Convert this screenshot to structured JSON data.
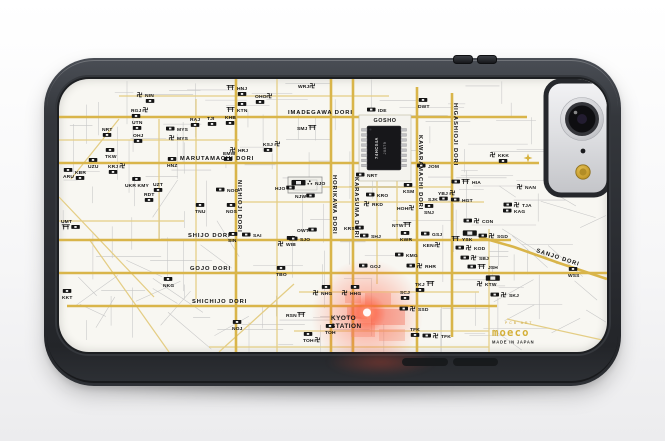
{
  "branding": {
    "logo_small": "PCB ART",
    "logo": "moeco",
    "made_in": "MADE IN JAPAN"
  },
  "map": {
    "chip": {
      "area_label": "GOSHO",
      "line1": "74HC04A",
      "line2": "J0879"
    },
    "station": {
      "line1": "KYOTO",
      "line2": "STATION"
    },
    "streets": {
      "horizontal": [
        {
          "name": "IMADEGAWA DORI",
          "y": 38,
          "x1": 0,
          "x2": 468,
          "lx": 229,
          "ly": 35
        },
        {
          "name": "MARUTAMACHI DORI",
          "y": 84,
          "x1": 0,
          "x2": 480,
          "lx": 121,
          "ly": 81
        },
        {
          "name": "SHIJO DORI",
          "y": 161,
          "x1": 0,
          "x2": 452,
          "lx": 129,
          "ly": 158
        },
        {
          "name": "GOJO DORI",
          "y": 194,
          "x1": 0,
          "x2": 548,
          "lx": 131,
          "ly": 191
        },
        {
          "name": "SHICHIJO DORI",
          "y": 227,
          "x1": 8,
          "x2": 438,
          "lx": 133,
          "ly": 224
        }
      ],
      "vertical": [
        {
          "name": "NISHIOJI DORI",
          "x": 177,
          "y1": 0,
          "y2": 273,
          "lx": 179,
          "ly": 101
        },
        {
          "name": "HORIKAWA DORI",
          "x": 272,
          "y1": 0,
          "y2": 273,
          "lx": 274,
          "ly": 96
        },
        {
          "name": "KARASUMA DORI",
          "x": 294,
          "y1": 0,
          "y2": 273,
          "lx": 296,
          "ly": 98
        },
        {
          "name": "KAWARAMACHI DORI",
          "x": 358,
          "y1": 8,
          "y2": 273,
          "lx": 360,
          "ly": 56
        },
        {
          "name": "HIGASHIOJI DORI",
          "x": 393,
          "y1": 14,
          "y2": 258,
          "lx": 395,
          "ly": 24
        }
      ],
      "diagonal": {
        "name": "SANJO DORI",
        "pts": "420,158 455,168 500,184 548,200",
        "lx": 477,
        "ly": 173,
        "rot": 18
      }
    },
    "minor_gold": [
      [
        60,
        17,
        330,
        17
      ],
      [
        0,
        61,
        180,
        61
      ],
      [
        230,
        108,
        392,
        108
      ],
      [
        180,
        123,
        425,
        123
      ],
      [
        0,
        142,
        125,
        142
      ],
      [
        240,
        213,
        420,
        213
      ],
      [
        235,
        252,
        430,
        252
      ],
      [
        150,
        268,
        430,
        268
      ],
      [
        137,
        20,
        137,
        220
      ],
      [
        218,
        0,
        218,
        273
      ],
      [
        318,
        84,
        318,
        205
      ],
      [
        338,
        84,
        338,
        161
      ],
      [
        430,
        150,
        430,
        273
      ],
      [
        100,
        40,
        100,
        160
      ],
      [
        30,
        160,
        110,
        273
      ],
      [
        0,
        118,
        95,
        218
      ],
      [
        160,
        273,
        235,
        205
      ],
      [
        12,
        100,
        60,
        40
      ],
      [
        448,
        240,
        548,
        262
      ]
    ],
    "labels": [
      [
        86,
        18,
        "NIN",
        "m",
        "",
        "",
        "r"
      ],
      [
        72,
        33,
        "RGJ",
        "",
        "m",
        "",
        "r"
      ],
      [
        73,
        45,
        "UTN",
        "",
        "",
        "",
        "r"
      ],
      [
        43,
        52,
        "NRT",
        "",
        "",
        "",
        "r"
      ],
      [
        74,
        58,
        "OHJ",
        "",
        "",
        "",
        "r"
      ],
      [
        131,
        42,
        "RAJ",
        "",
        "",
        "",
        "r"
      ],
      [
        148,
        41,
        "TJI",
        "",
        "",
        "",
        "r"
      ],
      [
        166,
        40,
        "KHB",
        "",
        "",
        "",
        "r"
      ],
      [
        118,
        52,
        "MYS",
        "r",
        "",
        "",
        ""
      ],
      [
        118,
        61,
        "MYS",
        "m",
        "",
        "",
        ""
      ],
      [
        178,
        33,
        "KTN",
        "t",
        "",
        "r",
        ""
      ],
      [
        178,
        11,
        "HNJ",
        "t",
        "",
        "",
        "r"
      ],
      [
        196,
        19,
        "OHO",
        "",
        "m",
        "",
        "r"
      ],
      [
        239,
        9,
        "WRJ",
        "",
        "m",
        "",
        ""
      ],
      [
        238,
        51,
        "SMJ",
        "",
        "t",
        "",
        ""
      ],
      [
        204,
        67,
        "KSJ",
        "",
        "m",
        "",
        "r"
      ],
      [
        179,
        73,
        "HRJ",
        "m",
        "",
        "",
        ""
      ],
      [
        164,
        76,
        "EMW",
        "",
        "",
        "",
        "r"
      ],
      [
        46,
        79,
        "TKW",
        "",
        "",
        "r",
        ""
      ],
      [
        29,
        89,
        "UZU",
        "",
        "",
        "r",
        ""
      ],
      [
        16,
        95,
        "KBR",
        "",
        "",
        "",
        "r"
      ],
      [
        4,
        99,
        "ARU",
        "",
        "",
        "r",
        ""
      ],
      [
        49,
        89,
        "KRJ",
        "",
        "m",
        "",
        "r"
      ],
      [
        108,
        88,
        "HNZ",
        "",
        "",
        "r",
        ""
      ],
      [
        66,
        108,
        "UKR KMY",
        "",
        "",
        "r",
        ""
      ],
      [
        94,
        107,
        "UZT",
        "",
        "",
        "",
        "r"
      ],
      [
        85,
        117,
        "RDT",
        "",
        "",
        "",
        "r"
      ],
      [
        168,
        113,
        "NOO",
        "r",
        "",
        "",
        ""
      ],
      [
        136,
        134,
        "TNU",
        "",
        "",
        "r",
        ""
      ],
      [
        167,
        134,
        "NOS",
        "",
        "",
        "r",
        ""
      ],
      [
        216,
        111,
        "HJO",
        "",
        "r",
        "",
        ""
      ],
      [
        236,
        119,
        "NJW",
        "",
        "r",
        "",
        ""
      ],
      [
        256,
        106,
        "NJO",
        "Rc",
        "",
        "",
        ""
      ],
      [
        2,
        144,
        "UMT",
        "",
        "",
        "",
        "tr"
      ],
      [
        169,
        163,
        "SIN",
        "",
        "",
        "r",
        ""
      ],
      [
        194,
        158,
        "SAI",
        "r",
        "",
        "",
        ""
      ],
      [
        227,
        167,
        "WIB",
        "m",
        "",
        "r",
        ""
      ],
      [
        238,
        153,
        "OWT",
        "",
        "r",
        "",
        ""
      ],
      [
        241,
        162,
        "SJO",
        "r",
        "",
        "",
        ""
      ],
      [
        285,
        151,
        "KRS",
        "",
        "r",
        "",
        ""
      ],
      [
        217,
        197,
        "TBO",
        "",
        "",
        "r",
        ""
      ],
      [
        104,
        208,
        "NKG",
        "",
        "",
        "r",
        ""
      ],
      [
        3,
        220,
        "KKT",
        "",
        "",
        "r",
        ""
      ],
      [
        173,
        251,
        "NOJ",
        "",
        "",
        "r",
        ""
      ],
      [
        262,
        216,
        "NHG",
        "m",
        "",
        "r",
        ""
      ],
      [
        291,
        216,
        "HHG",
        "m",
        "",
        "r",
        ""
      ],
      [
        227,
        238,
        "RSN",
        "",
        "t",
        "",
        ""
      ],
      [
        244,
        263,
        "TOH",
        "",
        "m",
        "r",
        ""
      ],
      [
        266,
        255,
        "TOH",
        "",
        "",
        "r",
        ""
      ],
      [
        341,
        215,
        "SCJ",
        "",
        "",
        "",
        "r"
      ],
      [
        359,
        232,
        "SSD",
        "rm",
        "",
        "",
        ""
      ],
      [
        351,
        252,
        "TFK",
        "",
        "",
        "",
        "r"
      ],
      [
        382,
        259,
        "TFK",
        "rm",
        "",
        "",
        ""
      ],
      [
        356,
        207,
        "TKJ",
        "",
        "t",
        "",
        "r"
      ],
      [
        413,
        105,
        "HIA",
        "rt",
        "",
        "",
        ""
      ],
      [
        466,
        110,
        "NAN",
        "m",
        "",
        "",
        ""
      ],
      [
        379,
        116,
        "YBJ",
        "",
        "m",
        "",
        ""
      ],
      [
        369,
        122,
        "SJK",
        "",
        "r",
        "",
        ""
      ],
      [
        403,
        123,
        "HGT",
        "r",
        "",
        "",
        ""
      ],
      [
        463,
        128,
        "TJA",
        "rm",
        "",
        "",
        ""
      ],
      [
        455,
        134,
        "KAG",
        "r",
        "",
        "",
        ""
      ],
      [
        313,
        127,
        "RKD",
        "m",
        "",
        "",
        ""
      ],
      [
        338,
        131,
        "HOH",
        "",
        "m",
        "",
        ""
      ],
      [
        365,
        135,
        "SNJ",
        "",
        "",
        "r",
        ""
      ],
      [
        318,
        118,
        "KRO",
        "r",
        "",
        "",
        ""
      ],
      [
        344,
        114,
        "KSM",
        "",
        "",
        "r",
        ""
      ],
      [
        308,
        98,
        "NRT",
        "r",
        "",
        "",
        ""
      ],
      [
        369,
        89,
        "JOM",
        "r",
        "",
        "",
        ""
      ],
      [
        319,
        33,
        "IDE",
        "r",
        "",
        "",
        ""
      ],
      [
        359,
        29,
        "DWT",
        "",
        "",
        "r",
        ""
      ],
      [
        439,
        78,
        "KKK",
        "m",
        "",
        "",
        "r"
      ],
      [
        423,
        144,
        "CON",
        "rm",
        "",
        "",
        ""
      ],
      [
        403,
        162,
        "YSK",
        "t",
        "",
        "R",
        ""
      ],
      [
        438,
        159,
        "SGD",
        "rm",
        "",
        "",
        ""
      ],
      [
        415,
        171,
        "KOD",
        "rm",
        "",
        "",
        ""
      ],
      [
        420,
        181,
        "SBJ",
        "rm",
        "",
        "",
        ""
      ],
      [
        429,
        190,
        "JSH",
        "rt",
        "",
        "",
        ""
      ],
      [
        426,
        207,
        "KTW",
        "m",
        "",
        "R",
        ""
      ],
      [
        450,
        218,
        "SKJ",
        "rm",
        "",
        "",
        ""
      ],
      [
        364,
        168,
        "KEN",
        "",
        "m",
        "",
        ""
      ],
      [
        373,
        157,
        "GSJ",
        "r",
        "",
        "",
        ""
      ],
      [
        341,
        162,
        "KWR",
        "",
        "",
        "r",
        ""
      ],
      [
        312,
        159,
        "SHJ",
        "r",
        "",
        "",
        ""
      ],
      [
        333,
        148,
        "NTW",
        "",
        "t",
        "",
        ""
      ],
      [
        347,
        178,
        "KMG",
        "r",
        "",
        "",
        ""
      ],
      [
        366,
        189,
        "RHR",
        "rm",
        "",
        "",
        ""
      ],
      [
        311,
        189,
        "GOJ",
        "r",
        "",
        "",
        ""
      ],
      [
        509,
        198,
        "WSS",
        "",
        "",
        "r",
        ""
      ]
    ]
  },
  "colors": {
    "trace_gold": "#d9b54a",
    "trace_gold_light": "#e4cd84",
    "trace_gray": "#c6c6c6",
    "pcb_white": "#f8f7f2",
    "case_dark": "#2d3035",
    "led_red": "#ff4633",
    "brand_gold": "#c9a132",
    "flash_gold": "#c79d2d",
    "label_ink": "#151515"
  }
}
